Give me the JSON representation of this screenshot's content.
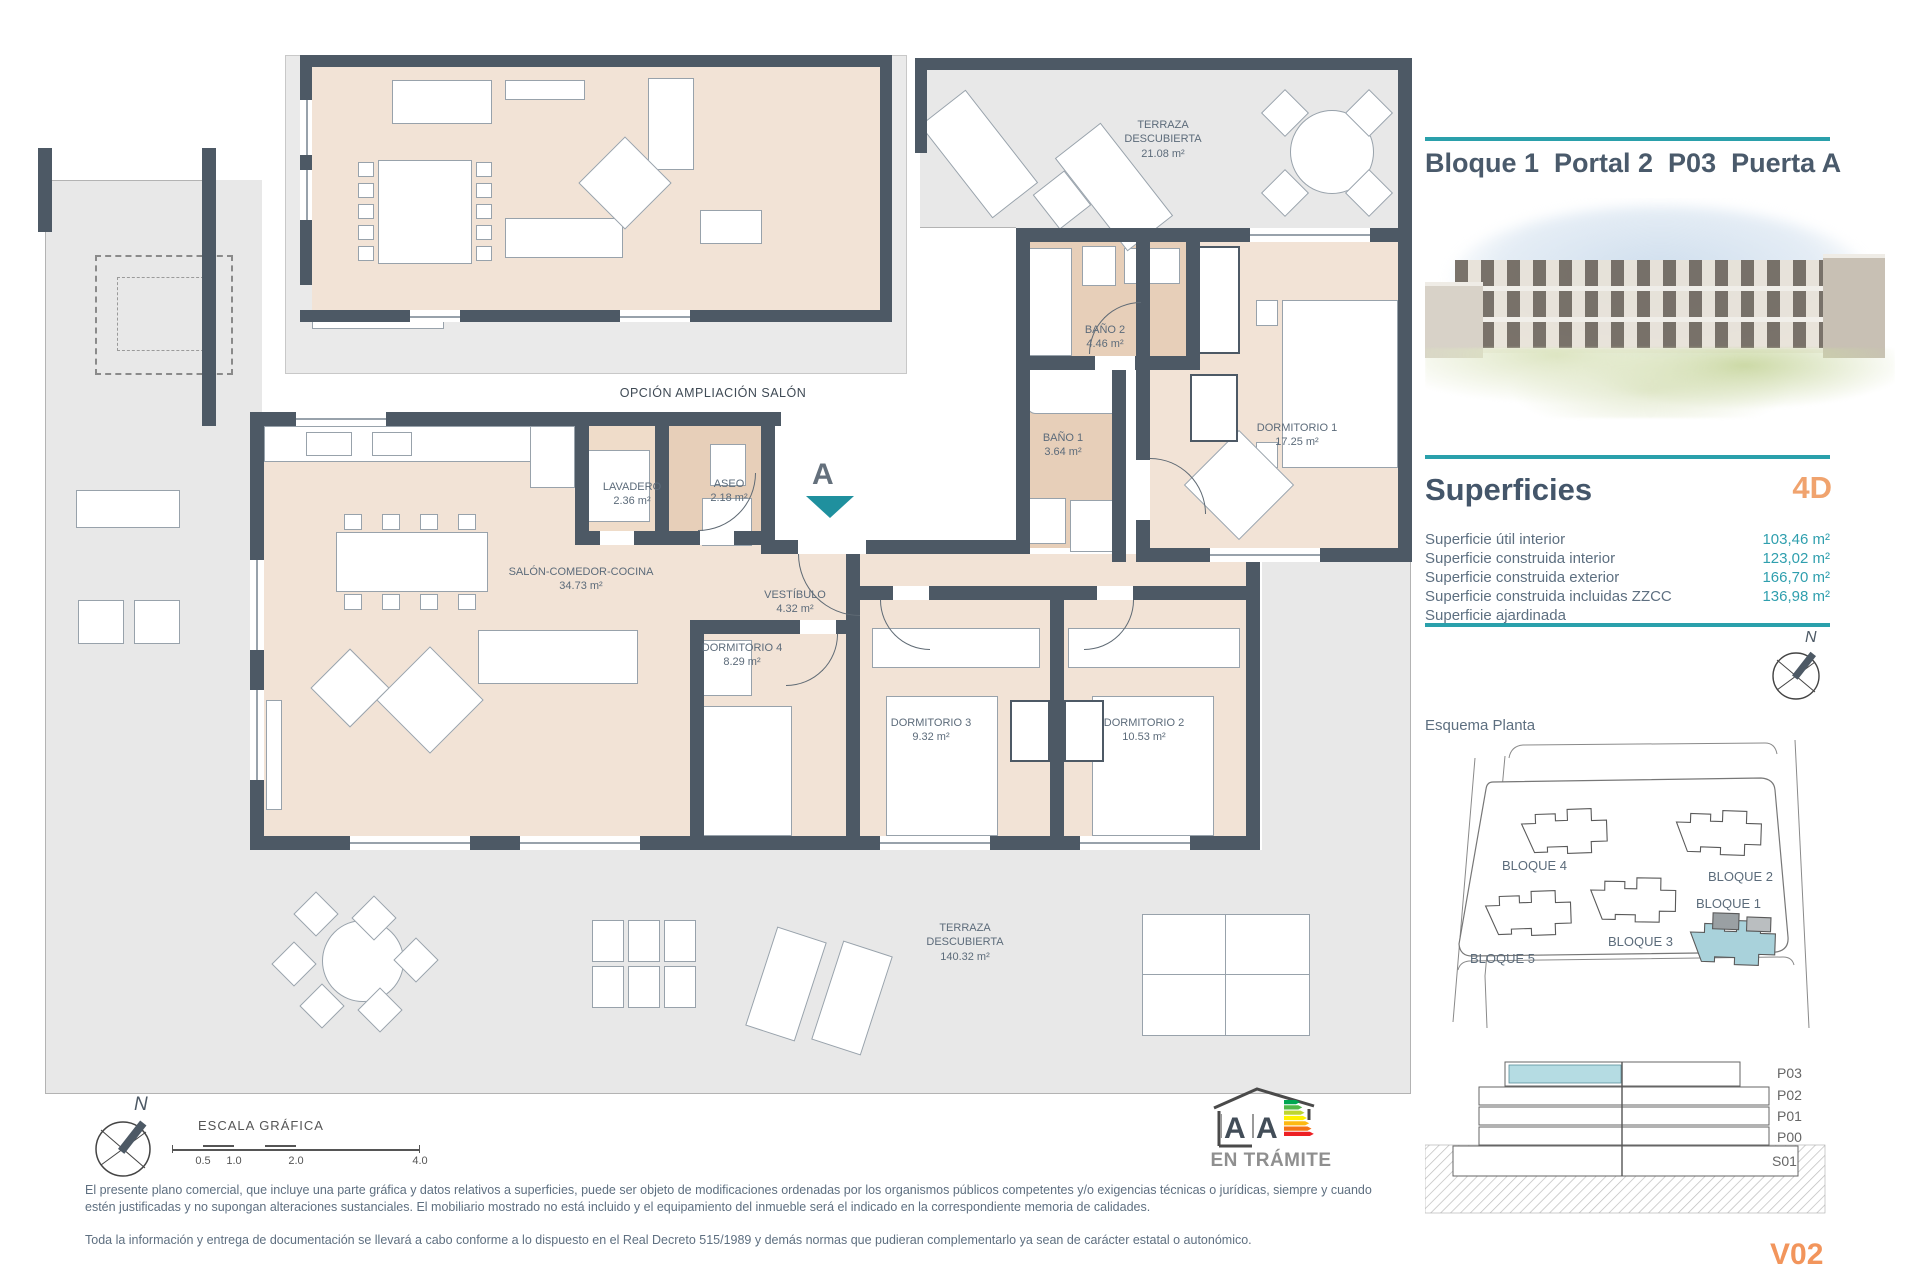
{
  "header": {
    "title": "Bloque 1  Portal 2  P03  Puerta A"
  },
  "superficies": {
    "heading": "Superficies",
    "type_code": "4D",
    "rows": [
      {
        "label": "Superficie útil interior",
        "value": "103,46 m²"
      },
      {
        "label": "Superficie construida interior",
        "value": "123,02 m²"
      },
      {
        "label": "Superficie construida exterior",
        "value": "166,70 m²"
      },
      {
        "label": "Superficie construida incluidas ZZCC",
        "value": "136,98 m²"
      },
      {
        "label": "Superficie ajardinada",
        "value": ""
      }
    ]
  },
  "esquema": {
    "heading": "Esquema Planta",
    "north_label": "N",
    "blocks": {
      "b1": "BLOQUE 1",
      "b2": "BLOQUE 2",
      "b3": "BLOQUE 3",
      "b4": "BLOQUE 4",
      "b5": "BLOQUE 5"
    }
  },
  "section_diagram": {
    "levels": {
      "p03": "P03",
      "p02": "P02",
      "p01": "P01",
      "p00": "P00",
      "s01": "S01"
    }
  },
  "plan": {
    "option_label": "OPCIÓN AMPLIACIÓN SALÓN",
    "entrance_marker": "A",
    "north_label": "N",
    "rooms": {
      "terraza_top": {
        "name": "TERRAZA DESCUBIERTA",
        "area": "21.08 m²"
      },
      "bano2": {
        "name": "BAÑO 2",
        "area": "4.46 m²"
      },
      "bano1": {
        "name": "BAÑO 1",
        "area": "3.64 m²"
      },
      "dorm1": {
        "name": "DORMITORIO 1",
        "area": "17.25 m²"
      },
      "lavadero": {
        "name": "LAVADERO",
        "area": "2.36 m²"
      },
      "aseo": {
        "name": "ASEO",
        "area": "2.18 m²"
      },
      "salon": {
        "name": "SALÓN-COMEDOR-COCINA",
        "area": "34.73 m²"
      },
      "vestibulo": {
        "name": "VESTÍBULO",
        "area": "4.32 m²"
      },
      "dorm4": {
        "name": "DORMITORIO 4",
        "area": "8.29 m²"
      },
      "dorm3": {
        "name": "DORMITORIO 3",
        "area": "9.32 m²"
      },
      "dorm2": {
        "name": "DORMITORIO 2",
        "area": "10.53 m²"
      },
      "terraza_bottom": {
        "name": "TERRAZA DESCUBIERTA",
        "area": "140.32 m²"
      }
    }
  },
  "scale_bar": {
    "label": "ESCALA GRÁFICA",
    "ticks": [
      "0.5",
      "1.0",
      "2.0",
      "4.0"
    ]
  },
  "energy": {
    "status": "EN TRÁMITE",
    "letter_left": "A",
    "letter_right": "A"
  },
  "footer": {
    "disclaimer1": "El presente plano comercial, que incluye una parte gráfica y datos relativos a superficies, puede ser objeto de modificaciones ordenadas por los organismos públicos competentes y/o exigencias técnicas o jurídicas, siempre y cuando estén justificadas y no supongan alteraciones sustanciales. El mobiliario mostrado no está incluido y el equipamiento del inmueble será el indicado en la correspondiente memoria de calidades.",
    "disclaimer2": "Toda la información y entrega de documentación se llevará a cabo conforme a lo dispuesto en el Real Decreto 515/1989 y demás normas que pudieran complementarlo ya sean de carácter estatal o autonómico.",
    "version": "V02"
  },
  "colors": {
    "accent_teal": "#2aa0ab",
    "accent_orange": "#f0a36e",
    "wall": "#4d5965",
    "highlight_blue": "#b5dce3"
  }
}
